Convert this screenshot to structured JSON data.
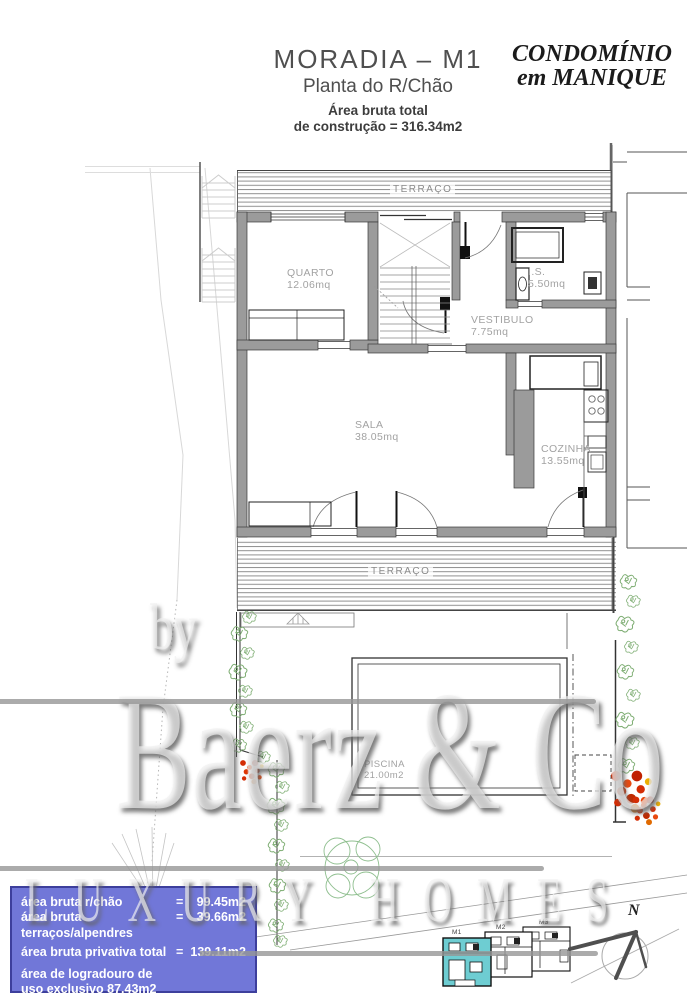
{
  "header": {
    "title": "MORADIA – M1",
    "subtitle": "Planta do R/Chão",
    "area_line1": "Área bruta total",
    "area_line2": "de construção = 316.34m2",
    "logo_line1": "CONDOMÍNIO",
    "logo_line2": "em MANIQUE"
  },
  "plan": {
    "terrace_top_label": "TERRAÇO",
    "terrace_bottom_label": "TERRAÇO",
    "rooms": [
      {
        "name": "QUARTO",
        "area": "12.06mq"
      },
      {
        "name": "I.S.",
        "area": "5.50mq"
      },
      {
        "name": "VESTIBULO",
        "area": "7.75mq"
      },
      {
        "name": "SALA",
        "area": "38.05mq"
      },
      {
        "name": "COZINHA",
        "area": "13.55mq"
      },
      {
        "name": "PISCINA",
        "area": "21.00m2"
      }
    ]
  },
  "watermark": {
    "by": "by",
    "name": "Baerz & Co",
    "tagline": "LUXURY HOMES"
  },
  "summary_box": {
    "rows": [
      {
        "label": "área bruta r/chão",
        "eq": "=",
        "value": "99.45m2"
      },
      {
        "label": "área bruta terraços/alpendres",
        "eq": "=",
        "value": "39.66m2"
      },
      {
        "label": "área bruta privativa total",
        "eq": "=",
        "value": "139.11m2"
      },
      {
        "label": "área de logradouro de",
        "eq": "",
        "value": ""
      },
      {
        "label": "uso exclusivo 87.43m2",
        "eq": "",
        "value": ""
      }
    ]
  },
  "key_plan": {
    "units": [
      {
        "label": "M1"
      },
      {
        "label": "M2"
      },
      {
        "label": "M3"
      }
    ],
    "highlight_color": "#6ecdd2"
  },
  "compass": {
    "label": "N"
  },
  "colors": {
    "summary_box_bg": "#7177d8",
    "summary_box_border": "#3d3f9c",
    "wall_gray": "#9b9b9b",
    "hedge_green": "#7fae74",
    "flower_red": "#d42d05",
    "keyplan_highlight": "#6ecdd2"
  }
}
